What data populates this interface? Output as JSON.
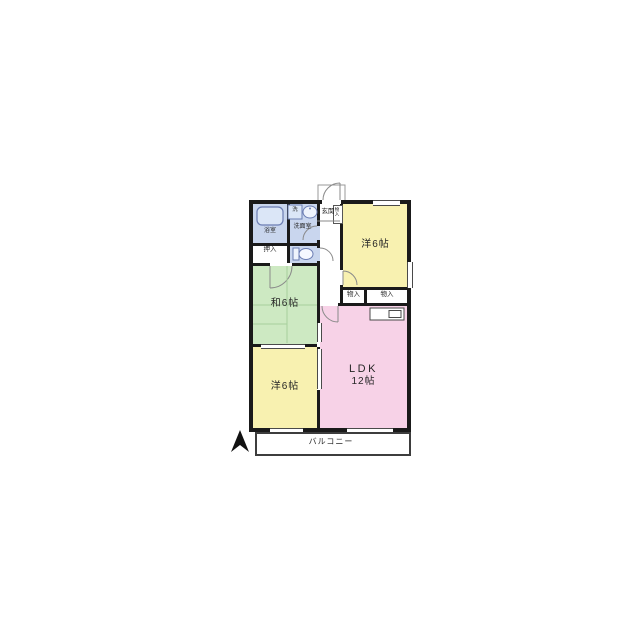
{
  "floorplan": {
    "labels": {
      "bath": "浴室",
      "laundry": "洗",
      "washroom": "洗面室",
      "closet": "押入",
      "entrance": "玄関",
      "entrance_storage": "物入",
      "bedroom_top": "洋6帖",
      "storage_left": "物入",
      "storage_right": "物入",
      "tatami_room": "和6帖",
      "bedroom_bottom": "洋6帖",
      "ldk_line1": "LDK",
      "ldk_line2": "12帖",
      "balcony": "バルコニー"
    },
    "colors": {
      "bedroom": "#f8f1b0",
      "tatami": "#cde9c2",
      "ldk": "#f7d2e7",
      "wet_area": "#c9d6ee",
      "wall": "#1a1a1a",
      "fixture_line": "#6b7db3"
    },
    "icons": [
      "north-arrow-icon",
      "bathtub-icon",
      "washing-machine-icon",
      "sink-icon",
      "toilet-icon",
      "kitchen-counter-icon",
      "door-swing-arc"
    ]
  }
}
